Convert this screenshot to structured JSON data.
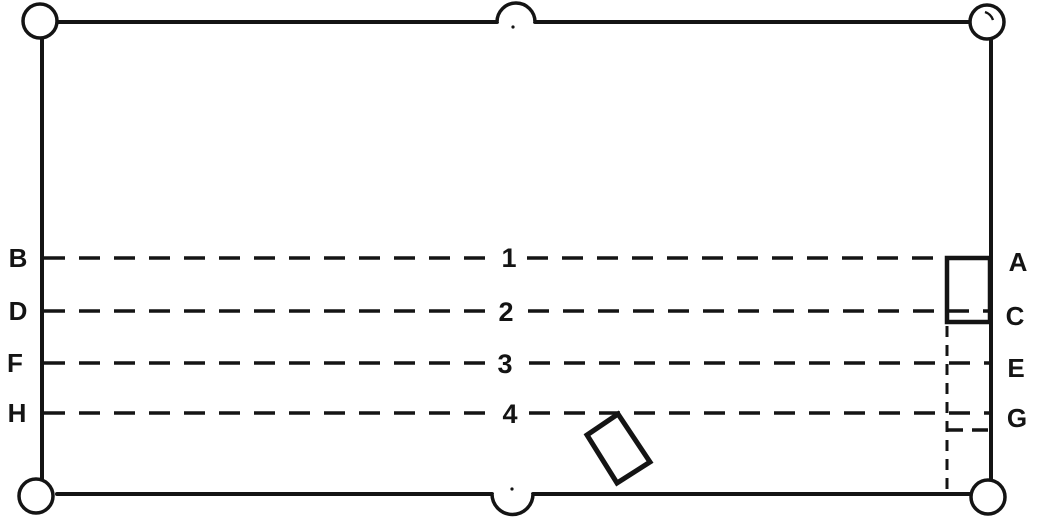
{
  "diagram": {
    "type": "billiard-table-top-view",
    "background_color": "#ffffff",
    "ink_color": "#141414",
    "left_labels": [
      "B",
      "D",
      "F",
      "H"
    ],
    "right_labels": [
      "A",
      "C",
      "E",
      "G"
    ],
    "line_numbers": [
      "1",
      "2",
      "3",
      "4"
    ],
    "lines": [
      {
        "number": "1",
        "left_label": "B",
        "right_label": "A"
      },
      {
        "number": "2",
        "left_label": "D",
        "right_label": "C"
      },
      {
        "number": "3",
        "left_label": "F",
        "right_label": "E"
      },
      {
        "number": "4",
        "left_label": "H",
        "right_label": "G"
      }
    ]
  }
}
